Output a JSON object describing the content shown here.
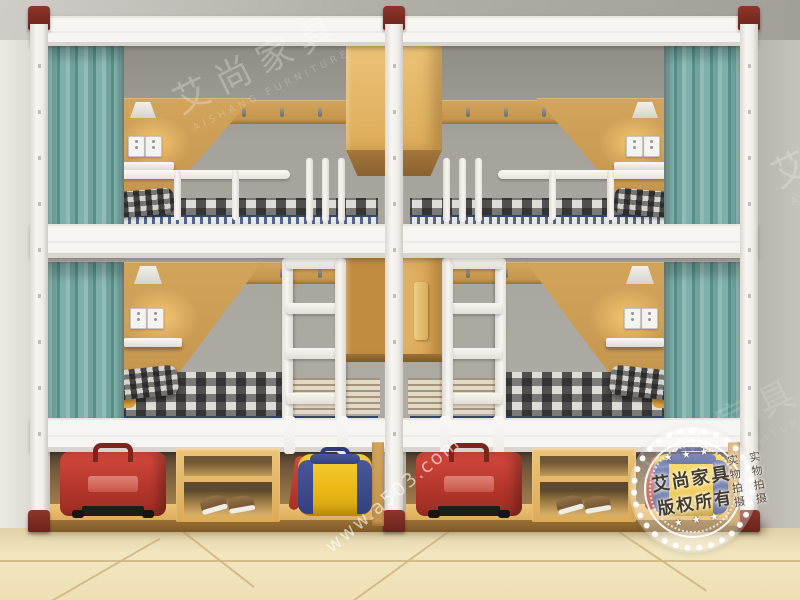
{
  "scene": {
    "description": "Showroom photo of two white steel bunk-bed units with teal privacy curtains, oak headboard panels, wall lamps, power sockets, central hanging oak cabinets, white ladders, plaid bedding and under-bed storage (red suitcases, shoe shelves, yellow-blue duffel bags) on a cream tiled floor.",
    "objects": [
      "white steel bunk frame",
      "maroon post caps and feet",
      "teal privacy curtains",
      "oak headboard panels",
      "wall lamps",
      "double power sockets",
      "small white shelves",
      "coat-hook rails",
      "hanging oak cabinets",
      "white ladders",
      "plaid mattresses",
      "plaid pillows",
      "yellow blankets",
      "blue striped mattress edges",
      "red suitcases",
      "wooden shoe shelves",
      "brown sneakers",
      "yellow-blue duffel bags",
      "cream tiled floor",
      "grey room walls and ceiling"
    ],
    "palette": {
      "ceiling": "#b2aea8",
      "wall": "#e7e4df",
      "back_wall": "#a6a29c",
      "frame_white": "#f5f3ef",
      "post_cap": "#7b2a21",
      "curtain_teal": "#7fb1aa",
      "wood_oak": "#c8994f",
      "wood_light": "#e5ba6b",
      "floor_tile": "#efe2b8",
      "suitcase_red": "#bf3a2f",
      "bag_yellow": "#eebb18",
      "bag_blue": "#3c4c8e",
      "mattress_edge_blue": "#33446e",
      "blanket_yellow": "#e0a33c"
    }
  },
  "watermarks": {
    "brand": "艾尚家具",
    "brand_sub": "AISHANG FURNITURE",
    "url": "www.a503.com",
    "badge": {
      "line1": "艾尚家具",
      "line2": "版权所有",
      "ring_left": "实物拍摄",
      "ring_right": "实物拍摄",
      "stars": "★ ★ ★"
    }
  }
}
